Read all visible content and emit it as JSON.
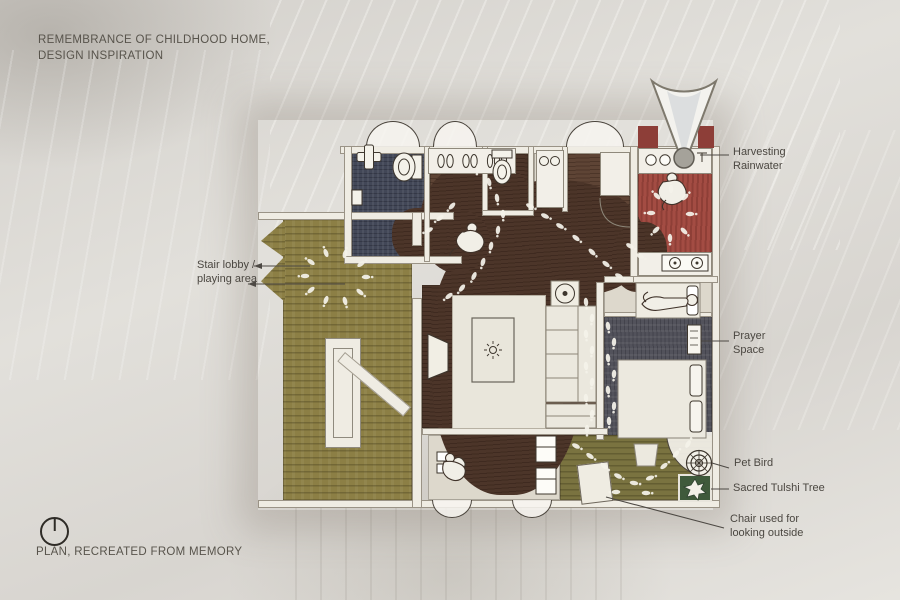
{
  "title": {
    "line1": "REMEMBRANCE OF CHILDHOOD HOME,",
    "line2": "DESIGN INSPIRATION"
  },
  "footer": {
    "label": "PLAN, RECREATED FROM MEMORY"
  },
  "annotations": {
    "harvesting_rainwater": {
      "line1": "Harvesting",
      "line2": "Rainwater"
    },
    "stair_lobby": {
      "line1": "Stair lobby /",
      "line2": "playing area"
    },
    "prayer_space": {
      "line1": "Prayer",
      "line2": "Space"
    },
    "pet_bird": {
      "label": "Pet Bird"
    },
    "sacred_tulshi_tree": {
      "label": "Sacred Tulshi Tree"
    },
    "chair_outside": {
      "line1": "Chair used for",
      "line2": "looking outside"
    }
  },
  "icons": {
    "footer_icon": "clock-icon",
    "rain_collector": "rain-funnel-icon",
    "pet_bird": "bird-cage-icon",
    "tulsi": "tulsi-plant-icon",
    "trails": "footprints"
  },
  "palette": {
    "paper": "#dcd9d3",
    "ink": "#3e372e",
    "label": "#4b4741",
    "titlecolor": "#58544c",
    "olive": "#8c7f45",
    "olivedark": "#7a7340",
    "walnut": "#5e4435",
    "walnutdeep": "#4c3529",
    "navy": "#424757",
    "red": "#a34c43",
    "reddark": "#8d3e38",
    "slate": "#52525b",
    "wall": "#efece3",
    "wallline": "#9a9386",
    "pale": "#ddd8cc",
    "rug": "#e9e6db",
    "tulsigreen": "#3f5a3b",
    "print": "#f4f2e9"
  }
}
